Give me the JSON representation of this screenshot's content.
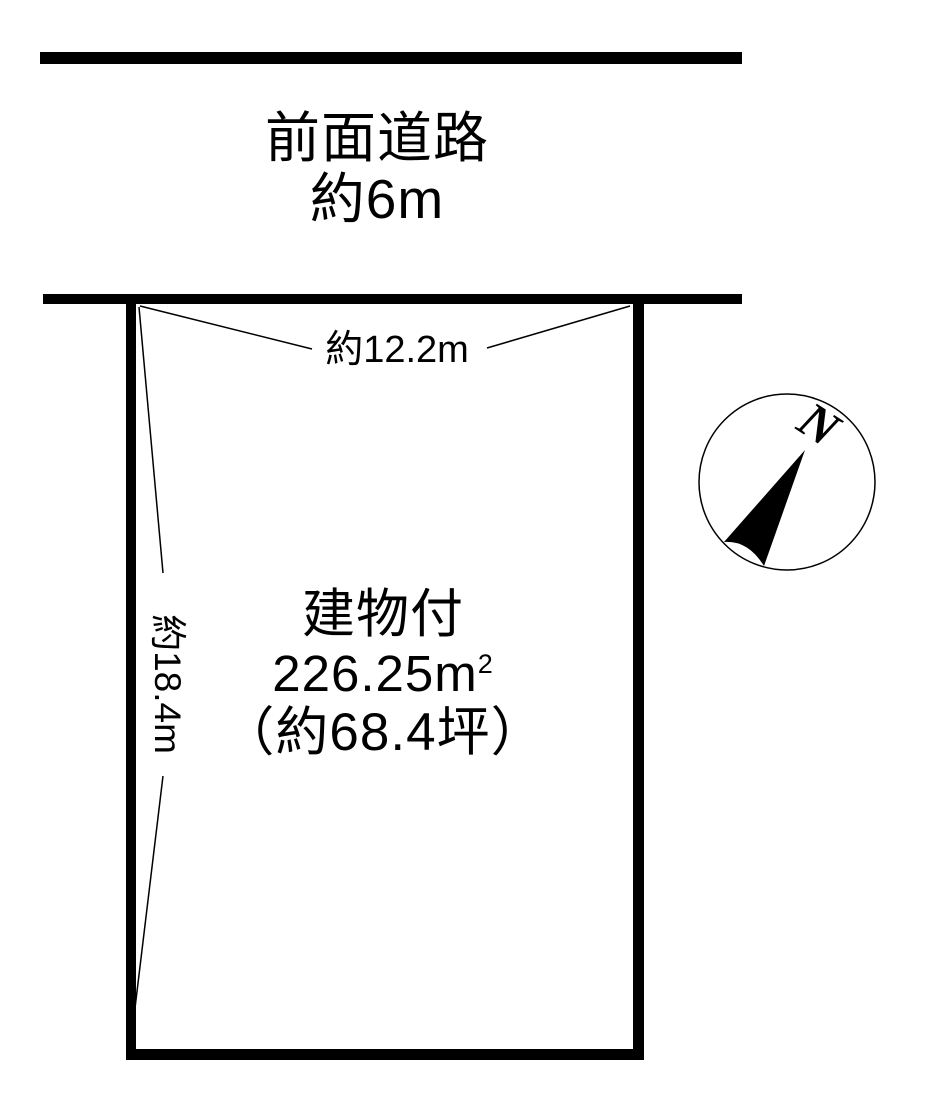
{
  "page": {
    "background_color": "#ffffff",
    "ink_color": "#000000"
  },
  "road": {
    "name": "前面道路",
    "width": "約6m"
  },
  "plot": {
    "frontage": "約12.2m",
    "depth": "約18.4m",
    "usage": "建物付",
    "area_sqm": "226.25m",
    "area_sqm_sup": "2",
    "area_tsubo": "（約68.4坪）"
  },
  "compass": {
    "north": "N"
  }
}
